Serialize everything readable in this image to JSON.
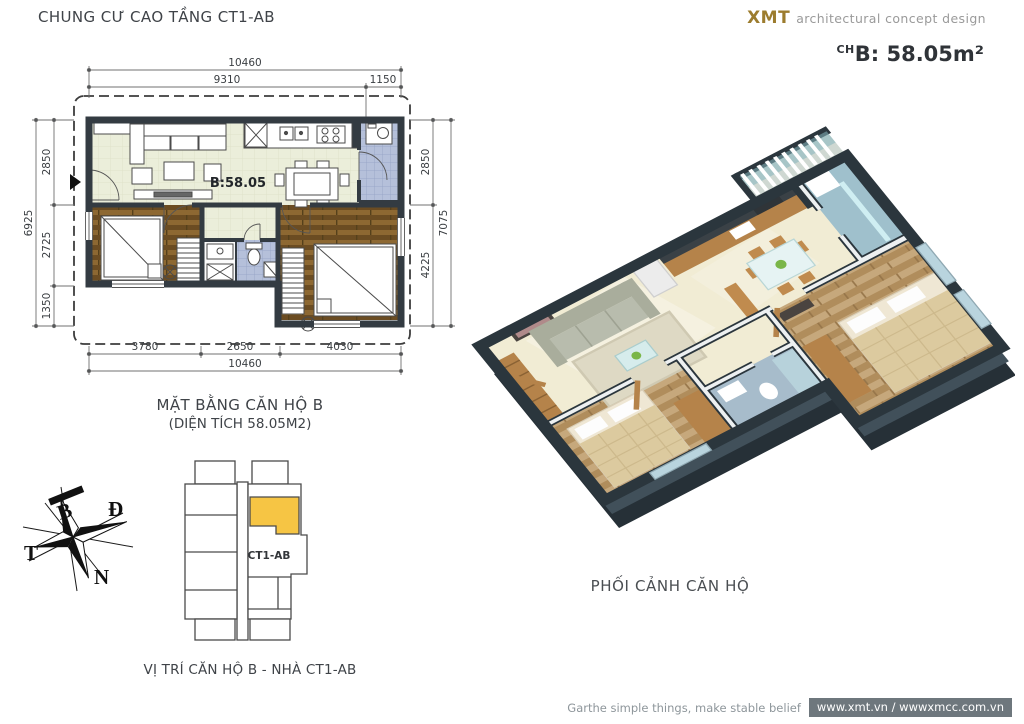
{
  "header": {
    "title": "CHUNG CƯ CAO TẦNG CT1-AB",
    "brand": "XMT",
    "brand_tagline": "architectural concept design",
    "unit_area_prefix": "CH",
    "unit_area_label": "B: 58.05m²"
  },
  "floor_plan": {
    "room_label": "B:58.05",
    "caption_line1": "MẶT BẰNG CĂN HỘ B",
    "caption_line2": "(DIỆN TÍCH 58.05M2)",
    "dims": {
      "top_overall": "10460",
      "top_left": "9310",
      "top_right": "1150",
      "left_overall": "6925",
      "left_segments": [
        "2850",
        "2725",
        "1350"
      ],
      "right_segments": [
        "2850",
        "4225"
      ],
      "right_overall": "7075",
      "bottom_segments": [
        "3780",
        "2650",
        "4030"
      ],
      "bottom_overall": "10460"
    }
  },
  "compass": {
    "north": "B",
    "east": "Đ",
    "south": "N",
    "west": "T"
  },
  "key_plan": {
    "building_label": "CT1-AB",
    "caption": "VỊ TRÍ CĂN HỘ B - NHÀ CT1-AB",
    "highlight_color": "#f6c544"
  },
  "render_3d": {
    "caption": "PHỐI CẢNH CĂN HỘ"
  },
  "footer": {
    "slogan": "Garthe simple things, make stable belief",
    "websites": "www.xmt.vn / wwwxmcc.com.vn"
  },
  "colors": {
    "brand_gold": "#9c7c2e",
    "wall_dark": "#333b42",
    "floor_cream": "#ebeeda",
    "floor_wood": "#7b582a",
    "tile_blue": "#b5c0da",
    "highlight_yellow": "#f6c544",
    "footer_badge": "#6e777d"
  }
}
